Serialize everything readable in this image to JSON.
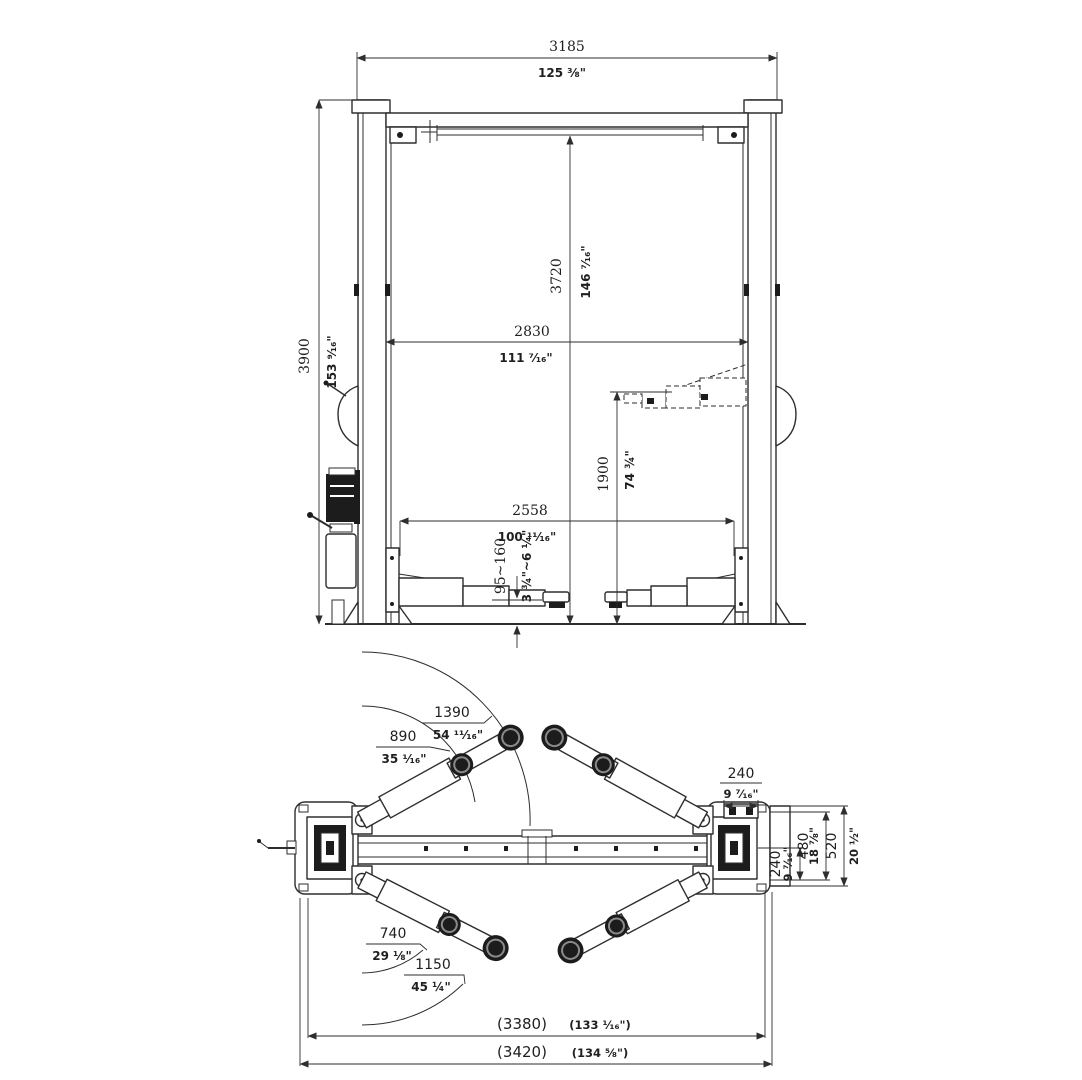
{
  "front_view": {
    "overall_width": {
      "mm": "3185",
      "in": "125 ⅜\""
    },
    "overall_height": {
      "mm": "3900",
      "in": "153 ⁹⁄₁₆\""
    },
    "clearance_height": {
      "mm": "3720",
      "in": "146 ⁷⁄₁₆\""
    },
    "between_columns": {
      "mm": "2830",
      "in": "111 ⁷⁄₁₆\""
    },
    "lift_height": {
      "mm": "1900",
      "in": "74 ¾\""
    },
    "drive_through": {
      "mm": "2558",
      "in": "100 ¹¹⁄₁₆\""
    },
    "pad_height": {
      "mm": "95~160",
      "in": "3 ¾\"~6 ¼\""
    }
  },
  "plan_view": {
    "front_arm_extended": {
      "mm": "1390",
      "in": "54 ¹¹⁄₁₆\""
    },
    "front_arm_retracted": {
      "mm": "890",
      "in": "35 ¹⁄₁₆\""
    },
    "rear_arm_retracted": {
      "mm": "740",
      "in": "29 ⅛\""
    },
    "rear_arm_extended": {
      "mm": "1150",
      "in": "45 ¼\""
    },
    "plate_width": {
      "mm": "240",
      "in": "9 ⁷⁄₁₆\""
    },
    "plate_offset": {
      "mm": "240",
      "in": "9 ⁷⁄₁₆\""
    },
    "plate_depth": {
      "mm": "480",
      "in": "18 ⅞\""
    },
    "plate_full_depth": {
      "mm": "520",
      "in": "20 ½\""
    },
    "overall_inner": {
      "mm": "(3380)",
      "in": "(133 ¹⁄₁₆\")"
    },
    "overall_outer": {
      "mm": "(3420)",
      "in": "(134 ⅝\")"
    }
  }
}
